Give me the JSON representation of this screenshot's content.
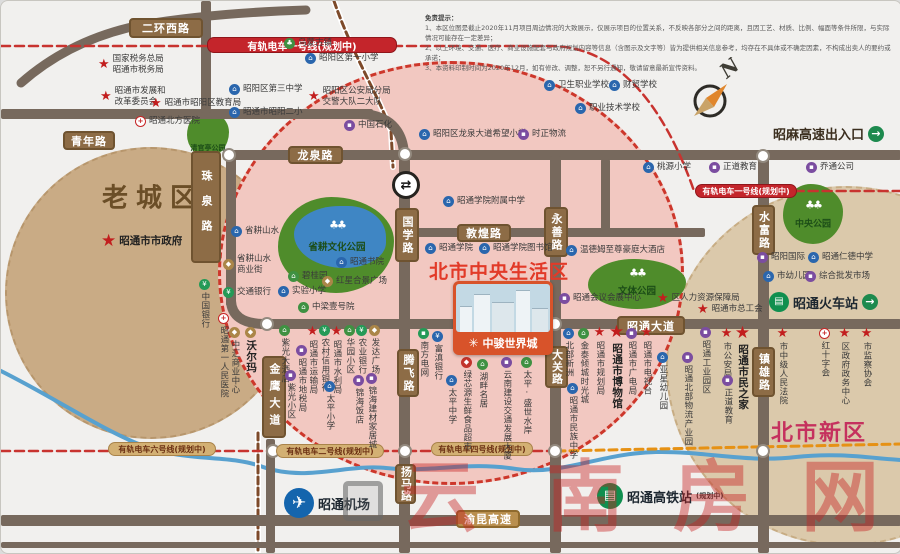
{
  "colors": {
    "road": "#77695d",
    "tram_red": "#c8332f",
    "rail_brown": "#7d4a2a",
    "orange_line": "#e69114",
    "river": "#58a1cf",
    "park_green": "#4f8c2b",
    "pink_zone": "#f2c8c1",
    "old_zone": "#c9ab85",
    "new_zone": "#dbc9ab"
  },
  "zones": [
    {
      "name": "old-town",
      "x": 4,
      "y": 146,
      "w": 292,
      "h": 292,
      "fill": "#c9ab85",
      "border": "#b7966c",
      "label": {
        "text": "老城区",
        "x": 152,
        "y": 195,
        "size": 26,
        "color": "#6b4e27",
        "ls": 8
      }
    },
    {
      "name": "north-new-district",
      "x": 665,
      "y": 185,
      "w": 360,
      "h": 360,
      "fill": "#dbc9ab",
      "border": "#c7ac83",
      "label": {
        "text": "北市新区",
        "x": 818,
        "y": 430,
        "size": 22,
        "color": "#c5315e",
        "ls": 2
      }
    },
    {
      "name": "central-living-circle",
      "x": 217,
      "y": 60,
      "w": 466,
      "h": 424,
      "fill": "#f2c8c1",
      "border": "#cd372b",
      "thick": true
    }
  ],
  "parks": [
    {
      "name": "qingguanting-park",
      "x": 186,
      "y": 110,
      "w": 42,
      "h": 46,
      "label": "清官亭公园",
      "lx": 207,
      "ly": 147,
      "ls": 7
    },
    {
      "name": "shenggeng-culture-park",
      "x": 277,
      "y": 196,
      "w": 116,
      "h": 96,
      "label": "省耕文化公园",
      "lx": 336,
      "ly": 245,
      "ls": 9.5,
      "lake": {
        "x": 293,
        "y": 205,
        "w": 92,
        "h": 62
      },
      "trees": {
        "x": 336,
        "y": 224
      }
    },
    {
      "name": "culture-sports-park",
      "x": 587,
      "y": 258,
      "w": 98,
      "h": 50,
      "label": "文体公园",
      "lx": 636,
      "ly": 289,
      "ls": 9.5,
      "trees": {
        "x": 636,
        "y": 272
      }
    },
    {
      "name": "central-park",
      "x": 782,
      "y": 183,
      "w": 60,
      "h": 60,
      "label": "中央公园",
      "lx": 812,
      "ly": 222,
      "ls": 9,
      "trees": {
        "x": 812,
        "y": 204
      }
    }
  ],
  "roads": [
    [
      0,
      108,
      372,
      10
    ],
    [
      200,
      0,
      10,
      112
    ],
    [
      222,
      149,
      678,
      10
    ],
    [
      225,
      157,
      10,
      148
    ],
    [
      398,
      158,
      11,
      394
    ],
    [
      549,
      155,
      11,
      397
    ],
    [
      757,
      155,
      11,
      397
    ],
    [
      404,
      227,
      300,
      9
    ],
    [
      600,
      158,
      9,
      72
    ],
    [
      258,
      318,
      642,
      10
    ],
    [
      0,
      514,
      900,
      11
    ],
    [
      0,
      541,
      900,
      6
    ],
    [
      265,
      438,
      9,
      114
    ]
  ],
  "road_curves": [
    {
      "d": "M20,82 Q70,38 140,24 Q210,12 305,9",
      "w": 9
    },
    {
      "d": "M362,113 Q400,116 403,152",
      "w": 10
    },
    {
      "d": "M230,300 Q231,322 262,323",
      "w": 10
    }
  ],
  "water_rail": [
    {
      "d": "M0,370 C50,395 95,425 135,442 C185,463 225,452 262,466 C305,481 345,463 385,467 C430,472 465,460 515,468 C560,475 600,452 655,451 C705,450 745,462 795,456 C840,451 875,458 900,459",
      "c": "#58a1cf",
      "w": 4
    },
    {
      "d": "M333,0 C352,55 378,95 390,130 L392,166",
      "c": "#7d4a2a",
      "w": 3,
      "dash": "7 4",
      "under": "#ffffff",
      "uw": 6
    },
    {
      "d": "M257,432 L257,552",
      "c": "#7d4a2a",
      "w": 3,
      "dash": "7 4",
      "under": "#ffffff",
      "uw": 6
    }
  ],
  "tram_lines": [
    {
      "d": "M0,45 L550,45 C610,45 660,95 693,190 L900,190",
      "c": "#c8332f",
      "w": 2.5,
      "dash": "9 5"
    },
    {
      "d": "M0,450 L556,450",
      "c": "#c8332f",
      "w": 2.5,
      "dash": "9 5"
    },
    {
      "d": "M556,450 L900,443",
      "c": "#e69114",
      "w": 3,
      "dash": "8 5"
    }
  ],
  "junctions": [
    [
      228,
      154
    ],
    [
      404,
      153
    ],
    [
      266,
      323
    ],
    [
      554,
      323
    ],
    [
      762,
      155
    ],
    [
      272,
      450
    ],
    [
      404,
      450
    ],
    [
      554,
      450
    ],
    [
      762,
      450
    ]
  ],
  "interchange": {
    "x": 405,
    "y": 184,
    "glyph": "⇄"
  },
  "road_labels": [
    {
      "x": 128,
      "y": 17,
      "w": 74,
      "h": 20,
      "t": "二环西路"
    },
    {
      "x": 62,
      "y": 130,
      "w": 52,
      "h": 19,
      "t": "青年路"
    },
    {
      "x": 190,
      "y": 150,
      "w": 30,
      "h": 112,
      "t": "珠泉路",
      "dir": "v",
      "ls": 14
    },
    {
      "x": 287,
      "y": 145,
      "w": 55,
      "h": 18,
      "t": "龙泉路"
    },
    {
      "x": 394,
      "y": 207,
      "w": 24,
      "h": 54,
      "t": "国学路",
      "dir": "v",
      "ls": 2
    },
    {
      "x": 456,
      "y": 223,
      "w": 54,
      "h": 18,
      "t": "敦煌路"
    },
    {
      "x": 543,
      "y": 206,
      "w": 24,
      "h": 50,
      "t": "永善路",
      "dir": "v",
      "ls": 2
    },
    {
      "x": 616,
      "y": 315,
      "w": 68,
      "h": 19,
      "t": "昭通大道"
    },
    {
      "x": 544,
      "y": 345,
      "w": 23,
      "h": 42,
      "t": "大关路",
      "dir": "v",
      "ls": 1
    },
    {
      "x": 261,
      "y": 355,
      "w": 24,
      "h": 82,
      "t": "金鹰大道",
      "dir": "v",
      "ls": 6
    },
    {
      "x": 396,
      "y": 348,
      "w": 22,
      "h": 48,
      "t": "腾飞路",
      "dir": "v",
      "ls": 2
    },
    {
      "x": 394,
      "y": 463,
      "w": 21,
      "h": 40,
      "t": "扬马路",
      "dir": "v",
      "ls": 1
    },
    {
      "x": 751,
      "y": 204,
      "w": 23,
      "h": 50,
      "t": "水富路",
      "dir": "v",
      "ls": 2
    },
    {
      "x": 751,
      "y": 346,
      "w": 23,
      "h": 50,
      "t": "镇雄路",
      "dir": "v",
      "ls": 2
    },
    {
      "x": 455,
      "y": 509,
      "w": 64,
      "h": 18,
      "t": "渝昆高速",
      "cls": "hwy"
    }
  ],
  "tram_labels": [
    {
      "x": 206,
      "y": 36,
      "w": 190,
      "h": 16,
      "v": "red",
      "t": "有轨电车一号线(规划中)",
      "fs": 10
    },
    {
      "x": 694,
      "y": 183,
      "w": 102,
      "h": 14,
      "v": "red",
      "t": "有轨电车一号线(规划中)",
      "fs": 8
    },
    {
      "x": 107,
      "y": 441,
      "w": 108,
      "h": 14,
      "v": "tan",
      "t": "有轨电车六号线(规划中)",
      "fs": 8
    },
    {
      "x": 275,
      "y": 443,
      "w": 108,
      "h": 14,
      "v": "tan",
      "t": "有轨电车二号线(规划中)",
      "fs": 8
    },
    {
      "x": 430,
      "y": 441,
      "w": 102,
      "h": 14,
      "v": "tan",
      "t": "有轨电车四号线(规划中)",
      "fs": 8
    }
  ],
  "pois": [
    {
      "x": 289,
      "y": 44,
      "t": "town",
      "l": "乌蒙古镇"
    },
    {
      "x": 103,
      "y": 60,
      "t": "star",
      "l": "国家税务总局\n昭通市税务局"
    },
    {
      "x": 105,
      "y": 92,
      "t": "star",
      "l": "昭通市发展和\n改革委员会"
    },
    {
      "x": 155,
      "y": 103,
      "t": "star",
      "l": "昭通市昭阳区教育局"
    },
    {
      "x": 140,
      "y": 122,
      "t": "hosp",
      "l": "昭通北方医院"
    },
    {
      "x": 234,
      "y": 90,
      "t": "school",
      "l": "昭阳区第三中学"
    },
    {
      "x": 234,
      "y": 113,
      "t": "school",
      "l": "昭通市昭阳二小"
    },
    {
      "x": 310,
      "y": 59,
      "t": "school",
      "l": "昭阳区第一小学"
    },
    {
      "x": 313,
      "y": 92,
      "t": "star",
      "l": "昭阳区公安局分局\n交警大队二大队"
    },
    {
      "x": 349,
      "y": 126,
      "t": "co",
      "l": "中国石化"
    },
    {
      "x": 424,
      "y": 135,
      "t": "school",
      "l": "昭阳区龙泉大道希望小学"
    },
    {
      "x": 523,
      "y": 135,
      "t": "co",
      "l": "时正物流"
    },
    {
      "x": 549,
      "y": 86,
      "t": "school",
      "l": "卫生职业学校"
    },
    {
      "x": 614,
      "y": 86,
      "t": "school",
      "l": "财贸学校"
    },
    {
      "x": 580,
      "y": 109,
      "t": "school",
      "l": "职业技术学校"
    },
    {
      "x": 648,
      "y": 168,
      "t": "school",
      "l": "桃源小学"
    },
    {
      "x": 714,
      "y": 168,
      "t": "co",
      "l": "正道教育"
    },
    {
      "x": 811,
      "y": 168,
      "t": "co",
      "l": "乔通公司"
    },
    {
      "x": 106,
      "y": 239,
      "t": "star",
      "l": "昭通市市政府",
      "b": 1
    },
    {
      "x": 236,
      "y": 232,
      "t": "school",
      "l": "省耕山水"
    },
    {
      "x": 228,
      "y": 260,
      "t": "shop",
      "l": "省耕山水\n商业街"
    },
    {
      "x": 203,
      "y": 284,
      "t": "bank",
      "l": "中国银行",
      "d": "v"
    },
    {
      "x": 228,
      "y": 293,
      "t": "bank",
      "l": "交通银行"
    },
    {
      "x": 293,
      "y": 277,
      "t": "resid",
      "l": "碧桂园"
    },
    {
      "x": 341,
      "y": 263,
      "t": "school",
      "l": "昭通书院"
    },
    {
      "x": 327,
      "y": 282,
      "t": "shop",
      "l": "红星合景广场"
    },
    {
      "x": 283,
      "y": 292,
      "t": "school",
      "l": "实验小学"
    },
    {
      "x": 303,
      "y": 308,
      "t": "resid",
      "l": "中梁壹号院"
    },
    {
      "x": 448,
      "y": 202,
      "t": "school",
      "l": "昭通学院附属中学"
    },
    {
      "x": 430,
      "y": 249,
      "t": "school",
      "l": "昭通学院"
    },
    {
      "x": 484,
      "y": 249,
      "t": "school",
      "l": "昭通学院图书馆"
    },
    {
      "x": 571,
      "y": 251,
      "t": "hotel",
      "l": "温德姆至尊豪庭大酒店"
    },
    {
      "x": 564,
      "y": 299,
      "t": "co",
      "l": "昭通会议会展中心"
    },
    {
      "x": 662,
      "y": 298,
      "t": "star",
      "l": "区人力资源保障局"
    },
    {
      "x": 702,
      "y": 309,
      "t": "star",
      "l": "昭通市总工会"
    },
    {
      "x": 762,
      "y": 258,
      "t": "co",
      "l": "昭阳国际"
    },
    {
      "x": 813,
      "y": 258,
      "t": "school",
      "l": "昭通仁德中学"
    },
    {
      "x": 768,
      "y": 277,
      "t": "school",
      "l": "市幼儿园"
    },
    {
      "x": 810,
      "y": 277,
      "t": "co",
      "l": "综合批发市场"
    },
    {
      "x": 222,
      "y": 318,
      "t": "hosp",
      "l": "昭通第一人民医院",
      "d": "v"
    },
    {
      "x": 233,
      "y": 332,
      "t": "shop",
      "l": "中汇商业中心",
      "d": "v"
    },
    {
      "x": 249,
      "y": 332,
      "t": "shop",
      "l": "沃尔玛",
      "d": "v",
      "b": 1
    },
    {
      "x": 283,
      "y": 330,
      "t": "resid",
      "l": "紫光大酒店",
      "d": "v"
    },
    {
      "x": 300,
      "y": 350,
      "t": "co",
      "l": "昭通市地税局",
      "d": "v"
    },
    {
      "x": 289,
      "y": 375,
      "t": "co",
      "l": "紫光小区",
      "d": "v"
    },
    {
      "x": 311,
      "y": 330,
      "t": "star",
      "l": "昭通市运输局",
      "d": "v"
    },
    {
      "x": 323,
      "y": 330,
      "t": "bank",
      "l": "农村信用银行",
      "d": "v"
    },
    {
      "x": 335,
      "y": 330,
      "t": "star",
      "l": "昭通市水利局",
      "d": "v"
    },
    {
      "x": 348,
      "y": 330,
      "t": "resid",
      "l": "华园小区",
      "d": "v"
    },
    {
      "x": 360,
      "y": 330,
      "t": "bank",
      "l": "农业银行",
      "d": "v"
    },
    {
      "x": 373,
      "y": 330,
      "t": "shop",
      "l": "发达广场",
      "d": "v"
    },
    {
      "x": 328,
      "y": 386,
      "t": "school",
      "l": "太平小学",
      "d": "v"
    },
    {
      "x": 357,
      "y": 380,
      "t": "co",
      "l": "锦海饭店",
      "d": "v"
    },
    {
      "x": 370,
      "y": 378,
      "t": "co",
      "l": "锦海建材家居城",
      "d": "v"
    },
    {
      "x": 422,
      "y": 333,
      "t": "util",
      "l": "南方电网",
      "d": "v"
    },
    {
      "x": 436,
      "y": 336,
      "t": "bankb",
      "l": "富滇银行",
      "d": "v"
    },
    {
      "x": 465,
      "y": 362,
      "t": "mart",
      "l": "绿芯源生鲜食品超市",
      "d": "v"
    },
    {
      "x": 450,
      "y": 380,
      "t": "school",
      "l": "太平中学",
      "d": "v"
    },
    {
      "x": 481,
      "y": 364,
      "t": "resid",
      "l": "湖畔名居",
      "d": "v"
    },
    {
      "x": 505,
      "y": 362,
      "t": "co",
      "l": "云南建设交通发展大厦",
      "d": "v"
    },
    {
      "x": 525,
      "y": 362,
      "t": "resid",
      "l": "太平·盛世水岸",
      "d": "v"
    },
    {
      "x": 567,
      "y": 333,
      "t": "school",
      "l": "北部新洲",
      "d": "v"
    },
    {
      "x": 582,
      "y": 333,
      "t": "resid",
      "l": "金泰倾城时光城",
      "d": "v"
    },
    {
      "x": 598,
      "y": 331,
      "t": "star",
      "l": "昭通市规划局",
      "d": "v"
    },
    {
      "x": 615,
      "y": 329,
      "t": "star",
      "l": "昭通市博物馆",
      "d": "v",
      "b": 1
    },
    {
      "x": 630,
      "y": 333,
      "t": "co",
      "l": "昭通市广电局",
      "d": "v"
    },
    {
      "x": 645,
      "y": 331,
      "t": "star",
      "l": "昭通市电视台",
      "d": "v"
    },
    {
      "x": 661,
      "y": 357,
      "t": "school",
      "l": "亚星幼儿园",
      "d": "v"
    },
    {
      "x": 686,
      "y": 357,
      "t": "co",
      "l": "昭通北部物流产业园",
      "d": "v"
    },
    {
      "x": 704,
      "y": 332,
      "t": "co",
      "l": "昭通工业园区",
      "d": "v"
    },
    {
      "x": 725,
      "y": 332,
      "t": "star",
      "l": "市公安局",
      "d": "v"
    },
    {
      "x": 726,
      "y": 380,
      "t": "co",
      "l": "正道教育",
      "d": "v"
    },
    {
      "x": 741,
      "y": 330,
      "t": "star",
      "l": "昭通市民之家",
      "d": "v",
      "b": 1
    },
    {
      "x": 781,
      "y": 332,
      "t": "star",
      "l": "市中级人民法院",
      "d": "v"
    },
    {
      "x": 823,
      "y": 333,
      "t": "hosp",
      "l": "红十字会",
      "d": "v"
    },
    {
      "x": 843,
      "y": 332,
      "t": "star",
      "l": "区政府政务中心",
      "d": "v"
    },
    {
      "x": 865,
      "y": 332,
      "t": "star",
      "l": "市监察协会",
      "d": "v"
    },
    {
      "x": 571,
      "y": 388,
      "t": "school",
      "l": "昭通市民族中学",
      "d": "v"
    }
  ],
  "landmark": {
    "district": "北市中央生活区",
    "name": "中骏世界城",
    "logo": "✳"
  },
  "stations": {
    "airport": {
      "label": "昭通机场"
    },
    "train": {
      "label": "昭通火车站",
      "arrow": "→"
    },
    "hsr": {
      "label": "昭通高铁站",
      "note": "(规划中)"
    }
  },
  "highway_exit": {
    "label": "昭麻高速出入口",
    "arrow": "→"
  },
  "compass": {
    "label": "N"
  },
  "watermark": {
    "items": [
      {
        "c": "云",
        "x": 400
      },
      {
        "c": "南",
        "x": 545
      },
      {
        "c": "房",
        "x": 672
      },
      {
        "c": "网",
        "x": 800
      }
    ],
    "y": 458
  },
  "disclaimer": {
    "title": "免责提示：",
    "lines": [
      "1、本区位图是截止2020年11月项目周边情况的大致展示，仅展示项目的位置关系，不反映各部分之间的距离，且因工艺、材质、比例、幅面等条件所限，与实际情况可能存在一定差异；",
      "2、以上环境、交通、医疗、商业设施配套与政府规划内容等信息（含图示及文字等）皆为提供相关信息参考，均存在不具体或不确定因素，不构成出卖人的要约或承诺；",
      "3、本资料印制时间为2020年12月，如有修改、调整，恕不另行通知，敬请留意最新宣传资料。"
    ]
  },
  "icon_glyphs": {
    "school": "⌂",
    "co": "▪",
    "bank": "¥",
    "bankb": "¥",
    "shop": "◆",
    "resid": "⌂",
    "town": "♣",
    "hotel": "⌂",
    "mart": "◆",
    "util": "▪",
    "hosp": "+"
  }
}
